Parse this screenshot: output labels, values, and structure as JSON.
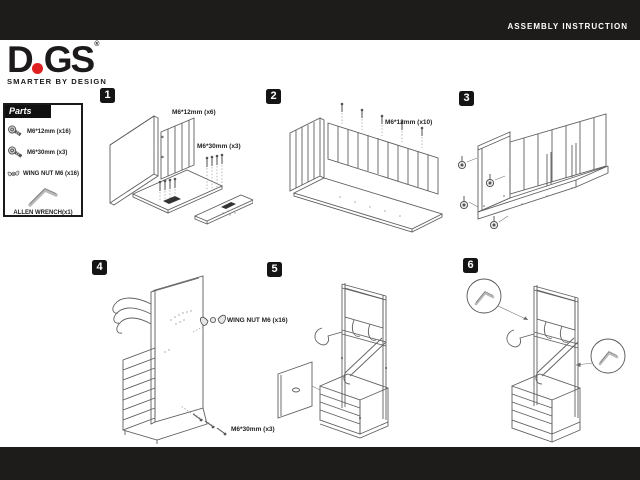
{
  "header": {
    "title": "ASSEMBLY INSTRUCTION"
  },
  "logo": {
    "part1": "D",
    "part2": "GS",
    "reg": "®",
    "tagline": "SMARTER BY DESIGN",
    "dot_color": "#e02020"
  },
  "parts": {
    "title": "Parts",
    "items": [
      {
        "icon": "bolt-icon",
        "label": "M6*12mm (x16)"
      },
      {
        "icon": "bolt-icon",
        "label": "M6*30mm (x3)"
      },
      {
        "icon": "wing-nut-icon",
        "label": "WING NUT M6 (x16)"
      },
      {
        "icon": "allen-wrench-icon",
        "label": "ALLEN WRENCH(x1)"
      }
    ]
  },
  "steps": [
    {
      "number": "1",
      "labels": {
        "a": "M6*12mm (x6)",
        "b": "M6*30mm (x3)"
      }
    },
    {
      "number": "2",
      "labels": {
        "a": "M6*12mm (x10)"
      }
    },
    {
      "number": "3",
      "labels": {}
    },
    {
      "number": "4",
      "labels": {
        "a": "WING NUT M6 (x16)",
        "b": "M6*30mm (x3)"
      }
    },
    {
      "number": "5",
      "labels": {}
    },
    {
      "number": "6",
      "labels": {}
    }
  ],
  "colors": {
    "bar_black": "#1e1b1b",
    "accent_red": "#e02020",
    "line_gray": "#5f5f5f"
  }
}
